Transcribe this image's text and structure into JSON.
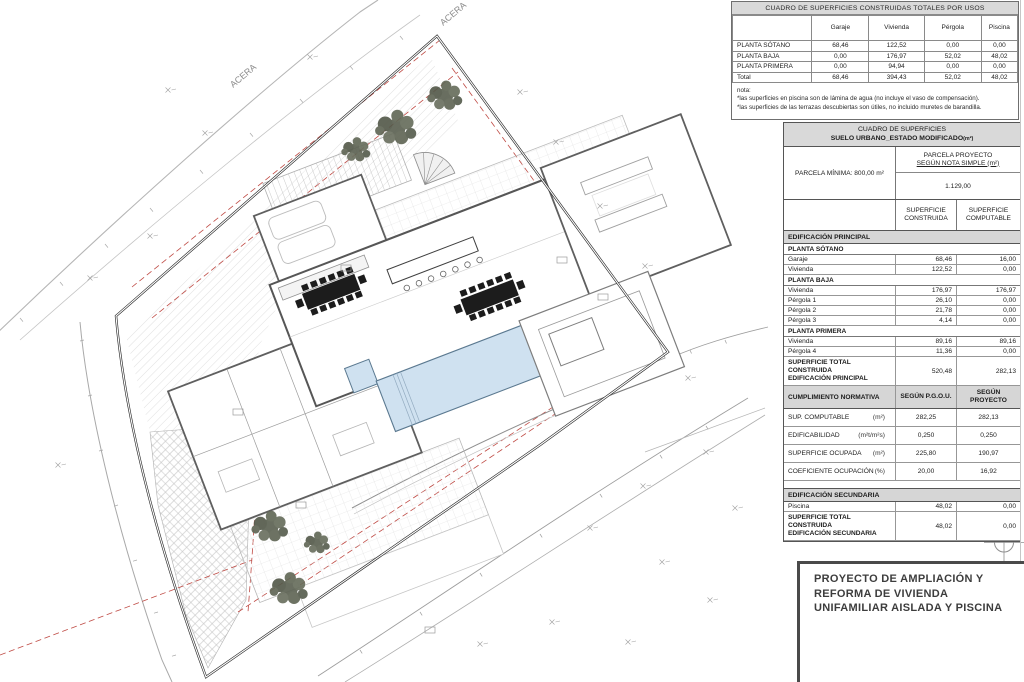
{
  "colors": {
    "accent_red": "#bf4a44",
    "pool_fill": "#cfe1f0",
    "tree": "#5c6252",
    "header_bg": "#d9d9d9"
  },
  "plan": {
    "labels": {
      "acera": "ACERA",
      "north": "N"
    }
  },
  "usage_table": {
    "title": "CUADRO DE SUPERFICIES CONSTRUIDAS TOTALES POR USOS",
    "columns": [
      "",
      "Garaje",
      "Vivienda",
      "Pérgola",
      "Piscina"
    ],
    "rows": [
      {
        "label": "PLANTA SÓTANO",
        "values": [
          "68,46",
          "122,52",
          "0,00",
          "0,00"
        ]
      },
      {
        "label": "PLANTA BAJA",
        "values": [
          "0,00",
          "176,97",
          "52,02",
          "48,02"
        ]
      },
      {
        "label": "PLANTA PRIMERA",
        "values": [
          "0,00",
          "94,94",
          "0,00",
          "0,00"
        ]
      },
      {
        "label": "Total",
        "values": [
          "68,46",
          "394,43",
          "52,02",
          "48,02"
        ]
      }
    ],
    "notes": [
      "nota:",
      "*las superficies en piscina son de lámina de agua (no incluye el vaso de compensación).",
      "*las superficies de las terrazas descubiertas son útiles, no incluido muretes de barandilla."
    ]
  },
  "surface_table": {
    "title1": "CUADRO DE SUPERFICIES",
    "title2": "SUELO URBANO_ESTADO MODIFICADO",
    "title_unit": "(m²)",
    "parcela_minima": "PARCELA MÍNIMA: 800,00 m²",
    "parcela_proyecto_l1": "PARCELA PROYECTO",
    "parcela_proyecto_l2": "SEGÚN NOTA SIMPLE (m²)",
    "parcela_proyecto_value": "1.129,00",
    "col1": "SUPERFICIE CONSTRUIDA",
    "col2": "SUPERFICIE COMPUTABLE",
    "rows": [
      {
        "t": "sec",
        "label": "EDIFICACIÓN PRINCIPAL"
      },
      {
        "t": "sub",
        "label": "PLANTA SÓTANO"
      },
      {
        "t": "d",
        "label": "Garaje",
        "c": "68,46",
        "p": "16,00"
      },
      {
        "t": "d",
        "label": "Vivienda",
        "c": "122,52",
        "p": "0,00"
      },
      {
        "t": "sub",
        "label": "PLANTA BAJA"
      },
      {
        "t": "d",
        "label": "Vivienda",
        "c": "176,97",
        "p": "176,97"
      },
      {
        "t": "d",
        "label": "Pérgola 1",
        "c": "26,10",
        "p": "0,00"
      },
      {
        "t": "d",
        "label": "Pérgola 2",
        "c": "21,78",
        "p": "0,00"
      },
      {
        "t": "d",
        "label": "Pérgola 3",
        "c": "4,14",
        "p": "0,00"
      },
      {
        "t": "sub",
        "label": "PLANTA PRIMERA"
      },
      {
        "t": "d",
        "label": "Vivienda",
        "c": "89,16",
        "p": "89,16"
      },
      {
        "t": "d",
        "label": "Pérgola 4",
        "c": "11,36",
        "p": "0,00"
      }
    ],
    "total_principal": {
      "l1": "SUPERFICIE TOTAL CONSTRUIDA",
      "l2": "EDIFICACIÓN PRINCIPAL",
      "c": "520,48",
      "p": "282,13"
    },
    "norm": {
      "title": "CUMPLIMIENTO NORMATIVA",
      "col1": "SEGÚN P.G.O.U.",
      "col2": "SEGÚN PROYECTO",
      "rows": [
        {
          "name": "SUP. COMPUTABLE",
          "unit": "(m²)",
          "a": "282,25",
          "b": "282,13"
        },
        {
          "name": "EDIFICABILIDAD",
          "unit": "(m²t/m²s)",
          "a": "0,250",
          "b": "0,250"
        },
        {
          "name": "SUPERFICIE OCUPADA",
          "unit": "(m²)",
          "a": "225,80",
          "b": "190,97"
        },
        {
          "name": "COEFICIENTE OCUPACIÓN",
          "unit": "(%)",
          "a": "20,00",
          "b": "16,92"
        }
      ]
    },
    "sec_title": "EDIFICACIÓN SECUNDARIA",
    "piscina_row": {
      "label": "Piscina",
      "c": "48,02",
      "p": "0,00"
    },
    "total_secundaria": {
      "l1": "SUPERFICIE TOTAL CONSTRUIDA",
      "l2": "EDIFICACIÓN SECUNDARIA",
      "c": "48,02",
      "p": "0,00"
    }
  },
  "titleblock": {
    "lines": [
      "PROYECTO DE AMPLIACIÓN Y",
      "REFORMA DE VIVIENDA",
      "UNIFAMILIAR AISLADA Y PISCINA"
    ]
  }
}
